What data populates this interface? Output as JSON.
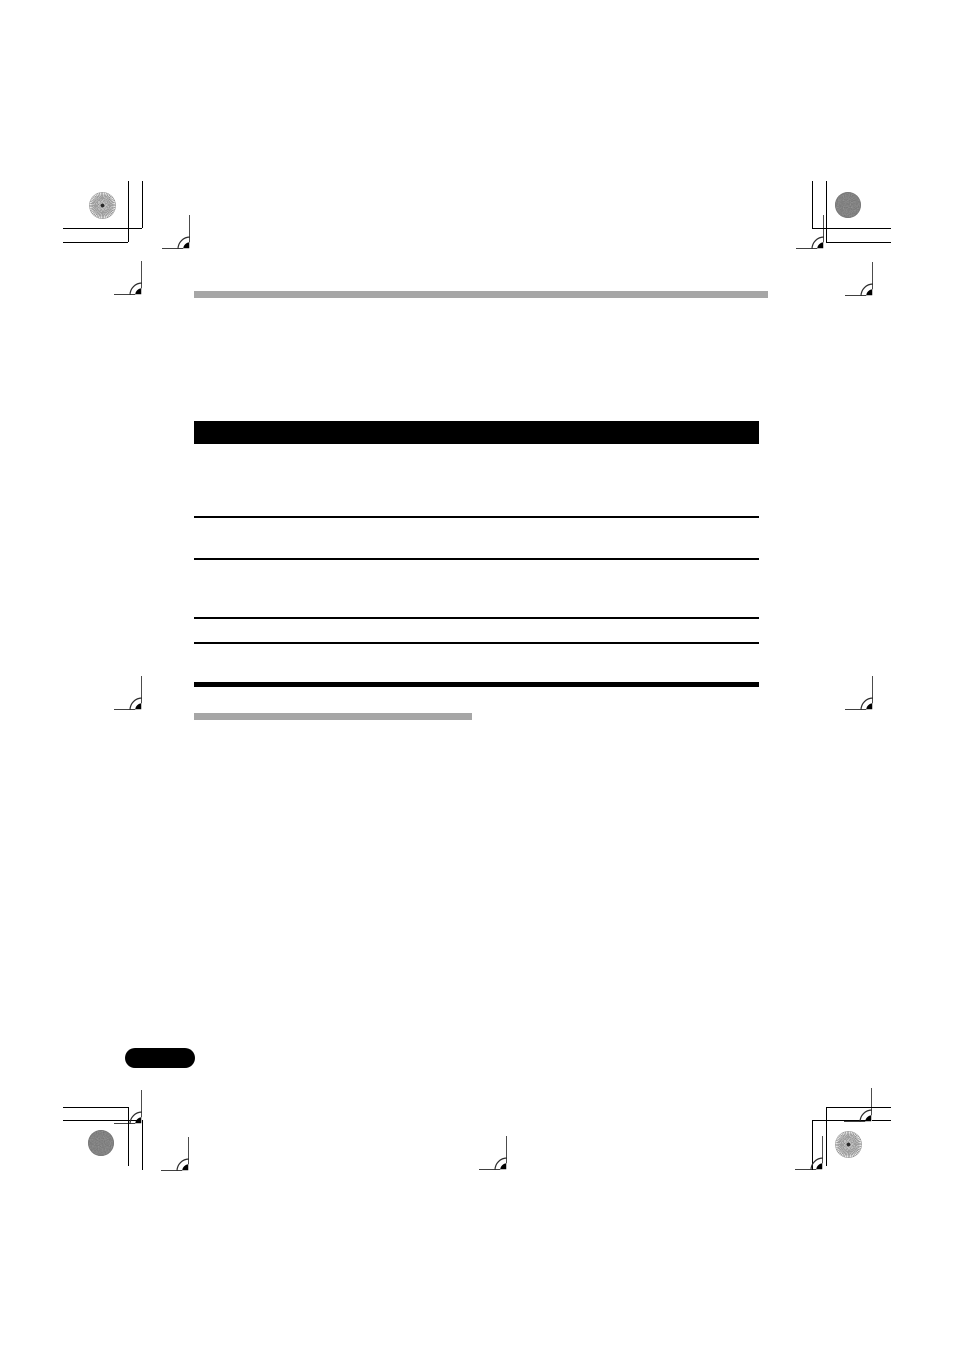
{
  "page": {
    "width": 954,
    "height": 1350,
    "background": "#ffffff"
  },
  "colors": {
    "rule_gray": "#a6a6a6",
    "ink_black": "#000000",
    "target_ring": "#2b2b2b",
    "granite_fill": "#6e6e6e",
    "pinwheel_gray": "#878787"
  },
  "content": {
    "heading_rule": {
      "x": 194,
      "y": 291,
      "w": 574,
      "h": 7
    },
    "table_header_bar": {
      "x": 194,
      "y": 421,
      "w": 565,
      "h": 23
    },
    "table_row_rules": [
      {
        "x": 194,
        "y": 516,
        "w": 565,
        "h": 2
      },
      {
        "x": 194,
        "y": 558,
        "w": 565,
        "h": 2
      },
      {
        "x": 194,
        "y": 617,
        "w": 565,
        "h": 2
      },
      {
        "x": 194,
        "y": 642,
        "w": 565,
        "h": 2
      }
    ],
    "table_bottom_rule": {
      "x": 194,
      "y": 682,
      "w": 565,
      "h": 5
    },
    "subheading_rule": {
      "x": 194,
      "y": 713,
      "w": 278,
      "h": 7
    },
    "page_number_tab": {
      "x": 125,
      "y": 1048,
      "w": 70,
      "h": 20,
      "radius": 10
    }
  },
  "prepress_marks": {
    "registration_targets": [
      {
        "cx": 160,
        "cy": 213
      },
      {
        "cx": 112,
        "cy": 259
      },
      {
        "cx": 794,
        "cy": 213
      },
      {
        "cx": 843,
        "cy": 260
      },
      {
        "cx": 112,
        "cy": 674
      },
      {
        "cx": 843,
        "cy": 674
      },
      {
        "cx": 112,
        "cy": 1088
      },
      {
        "cx": 159,
        "cy": 1135
      },
      {
        "cx": 842,
        "cy": 1086
      },
      {
        "cx": 793,
        "cy": 1134
      },
      {
        "cx": 477,
        "cy": 1134
      }
    ],
    "pinwheel_circles": [
      {
        "cx": 102,
        "cy": 205
      },
      {
        "cx": 848,
        "cy": 1144
      }
    ],
    "granite_circles": [
      {
        "cx": 848,
        "cy": 205
      },
      {
        "cx": 101,
        "cy": 1143
      }
    ],
    "crop_lines": [
      {
        "x": 128,
        "y": 181,
        "w": 1.4,
        "h": 61
      },
      {
        "x": 142,
        "y": 181,
        "w": 1.4,
        "h": 47
      },
      {
        "x": 63,
        "y": 228,
        "w": 79,
        "h": 1.4
      },
      {
        "x": 63,
        "y": 242,
        "w": 65,
        "h": 1.4
      },
      {
        "x": 826,
        "y": 181,
        "w": 1.4,
        "h": 61
      },
      {
        "x": 812,
        "y": 181,
        "w": 1.4,
        "h": 47
      },
      {
        "x": 812,
        "y": 228,
        "w": 79,
        "h": 1.4
      },
      {
        "x": 826,
        "y": 242,
        "w": 65,
        "h": 1.4
      },
      {
        "x": 128,
        "y": 1107,
        "w": 1.4,
        "h": 59
      },
      {
        "x": 142,
        "y": 1120,
        "w": 1.4,
        "h": 50
      },
      {
        "x": 63,
        "y": 1107,
        "w": 65,
        "h": 1.4
      },
      {
        "x": 63,
        "y": 1120,
        "w": 79,
        "h": 1.4
      },
      {
        "x": 826,
        "y": 1107,
        "w": 1.4,
        "h": 59
      },
      {
        "x": 812,
        "y": 1120,
        "w": 1.4,
        "h": 50
      },
      {
        "x": 826,
        "y": 1107,
        "w": 65,
        "h": 1.4
      },
      {
        "x": 812,
        "y": 1120,
        "w": 79,
        "h": 1.4
      }
    ]
  }
}
